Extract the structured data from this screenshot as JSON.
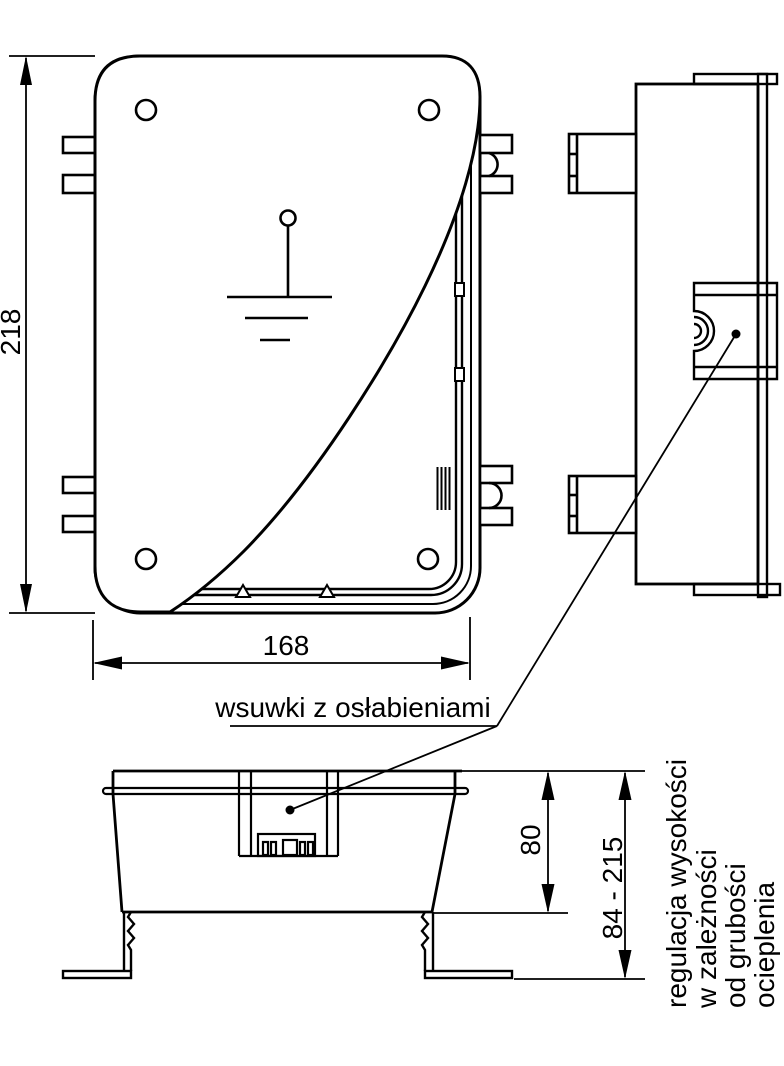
{
  "drawing": {
    "type": "technical-drawing",
    "subject": "flush-mount junction box, three orthographic views",
    "colors": {
      "line": "#000000",
      "background": "#ffffff"
    },
    "dimensions": {
      "front_height": "218",
      "front_width": "168",
      "body_depth": "80",
      "adjustable_height": "84 - 215"
    },
    "labels": {
      "slides_note": "wsuwki z osłabieniami",
      "height_note_lines": [
        "regulacja wysokości",
        "w zależności",
        "od grubości",
        "ocieplenia"
      ]
    }
  }
}
